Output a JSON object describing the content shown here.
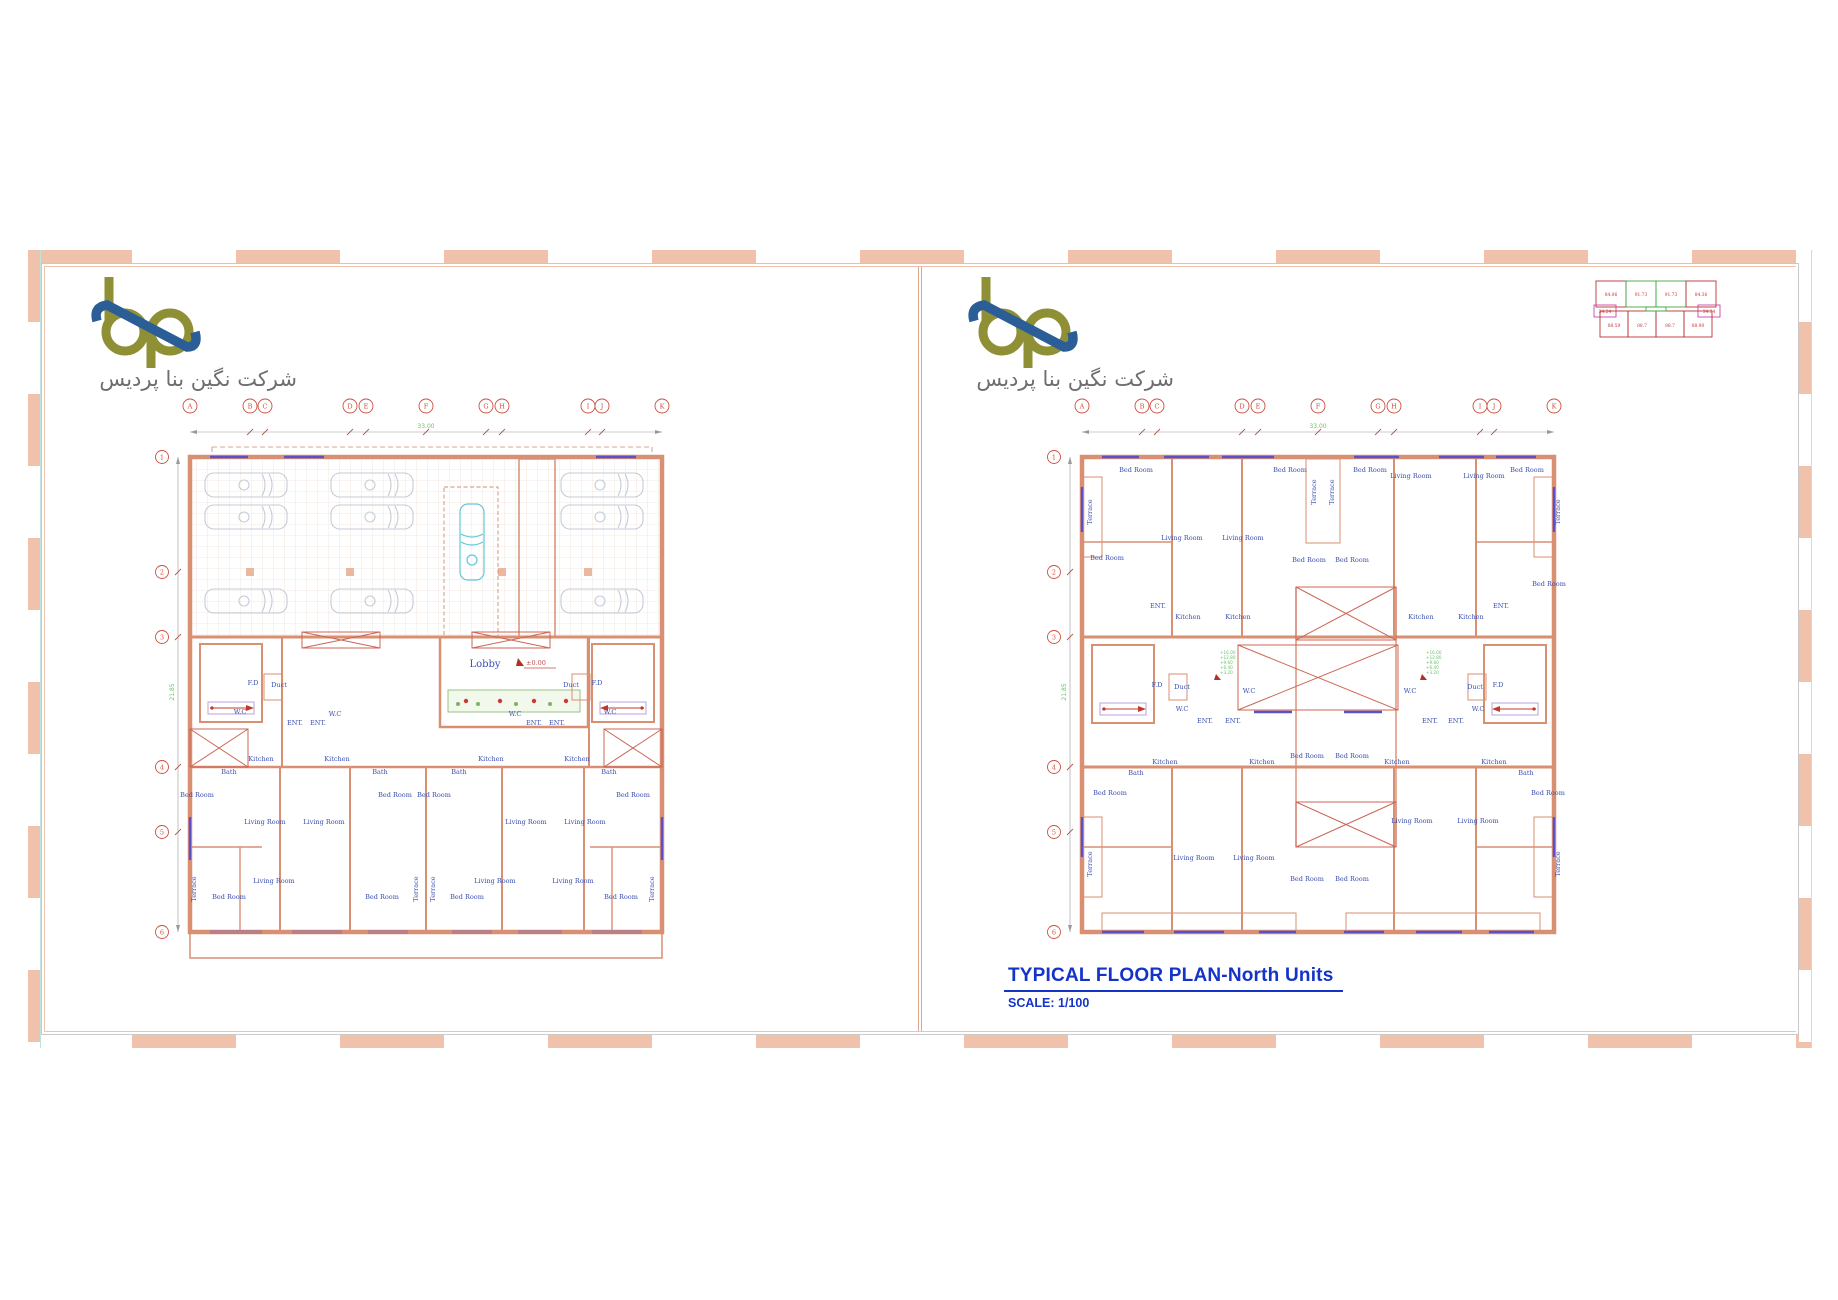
{
  "company": {
    "name_fa": "شرکت نگین بنا پردیس"
  },
  "logo": {
    "olive": "#8f9036",
    "blue": "#2b5e97"
  },
  "colors": {
    "border_salmon": "#f1c2ab",
    "wall_salmon": "#d98f72",
    "label_blue": "#3b4fb0",
    "grid_red": "#cd4f3f",
    "dim_green": "#79c779",
    "window_purple": "#5b50c8",
    "ramp_cyan": "#62c8d8",
    "title_blue": "#1433c8",
    "hatch_cyan": "#bfe3e0"
  },
  "grid": {
    "cols": [
      "A",
      "B",
      "C",
      "D",
      "E",
      "F",
      "G",
      "H",
      "I",
      "J",
      "K"
    ],
    "rows": [
      "1",
      "2",
      "3",
      "4",
      "5",
      "6"
    ],
    "h_total": "33.00",
    "v_total": "21.85"
  },
  "labels": {
    "lobby": "Lobby",
    "level_zero": "±0.00",
    "bed_room": "Bed Room",
    "living_room": "Living Room",
    "kitchen": "Kitchen",
    "bath": "Bath",
    "wc": "W.C",
    "ent": "ENT.",
    "duct": "Duct",
    "fd": "F.D",
    "terrace": "Terrace"
  },
  "levels": [
    "+16.00",
    "+12.80",
    "+9.60",
    "+6.40",
    "+3.20"
  ],
  "key_plan": {
    "top": [
      "84.06",
      "91.73",
      "91.73",
      "84.36"
    ],
    "mid": [
      "34.24",
      "34.34"
    ],
    "bottom": [
      "88.59",
      "88.7",
      "88.7",
      "88.90"
    ]
  },
  "title_block": {
    "title": "TYPICAL FLOOR PLAN-North Units",
    "scale": "SCALE: 1/100"
  }
}
